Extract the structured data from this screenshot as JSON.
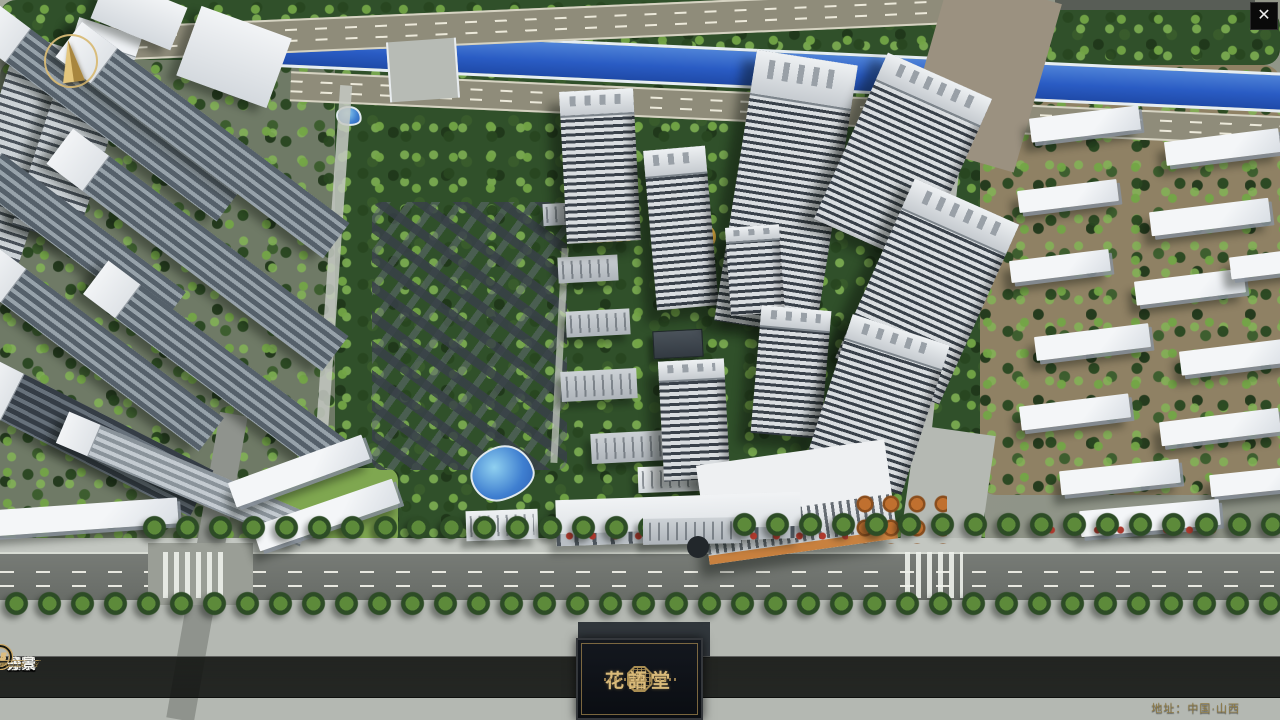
{
  "app": {
    "title": "花語堂 楼盘数字展示系统"
  },
  "logo": {
    "title": "花語堂",
    "emblem_icon": "octagonal-seal-icon"
  },
  "nav": {
    "items": [
      {
        "num": "o1",
        "zh": "品牌 · 介绍",
        "en": "BRAND SUPPORT"
      },
      {
        "num": "o2",
        "zh": "区位 · 价值",
        "en": "LOCATION VALUE"
      },
      {
        "num": "o3",
        "zh": "项目 · 概况",
        "en": "PROJECT SURVEY"
      },
      {
        "num": "o4",
        "zh": "建筑 · 鉴赏",
        "en": "APPRECIATION"
      },
      {
        "num": "o5",
        "zh": "园林 · 景观",
        "en": "GARDEN STREET"
      },
      {
        "num": "o6",
        "zh": "精装 · 体验",
        "en": "EXPERIENCE"
      },
      {
        "num": "o7",
        "zh": "户型 · 分布",
        "en": "SHOW ROOM"
      },
      {
        "num": "o8",
        "zh": "一房 · 一景",
        "en": "COMMUNITY"
      }
    ]
  },
  "footer": {
    "address": "地址：中国·山西"
  },
  "icons": {
    "close": "✕",
    "compass": "north-arrow",
    "logo_emblem": "octagonal-seal"
  },
  "colors": {
    "accent_gold": "#c9a565",
    "bar_bg": "#0a0c0a",
    "river_blue": "#2e62c8",
    "tree_green": "#3a5c2c",
    "title_gold": "#d9ba7a"
  }
}
